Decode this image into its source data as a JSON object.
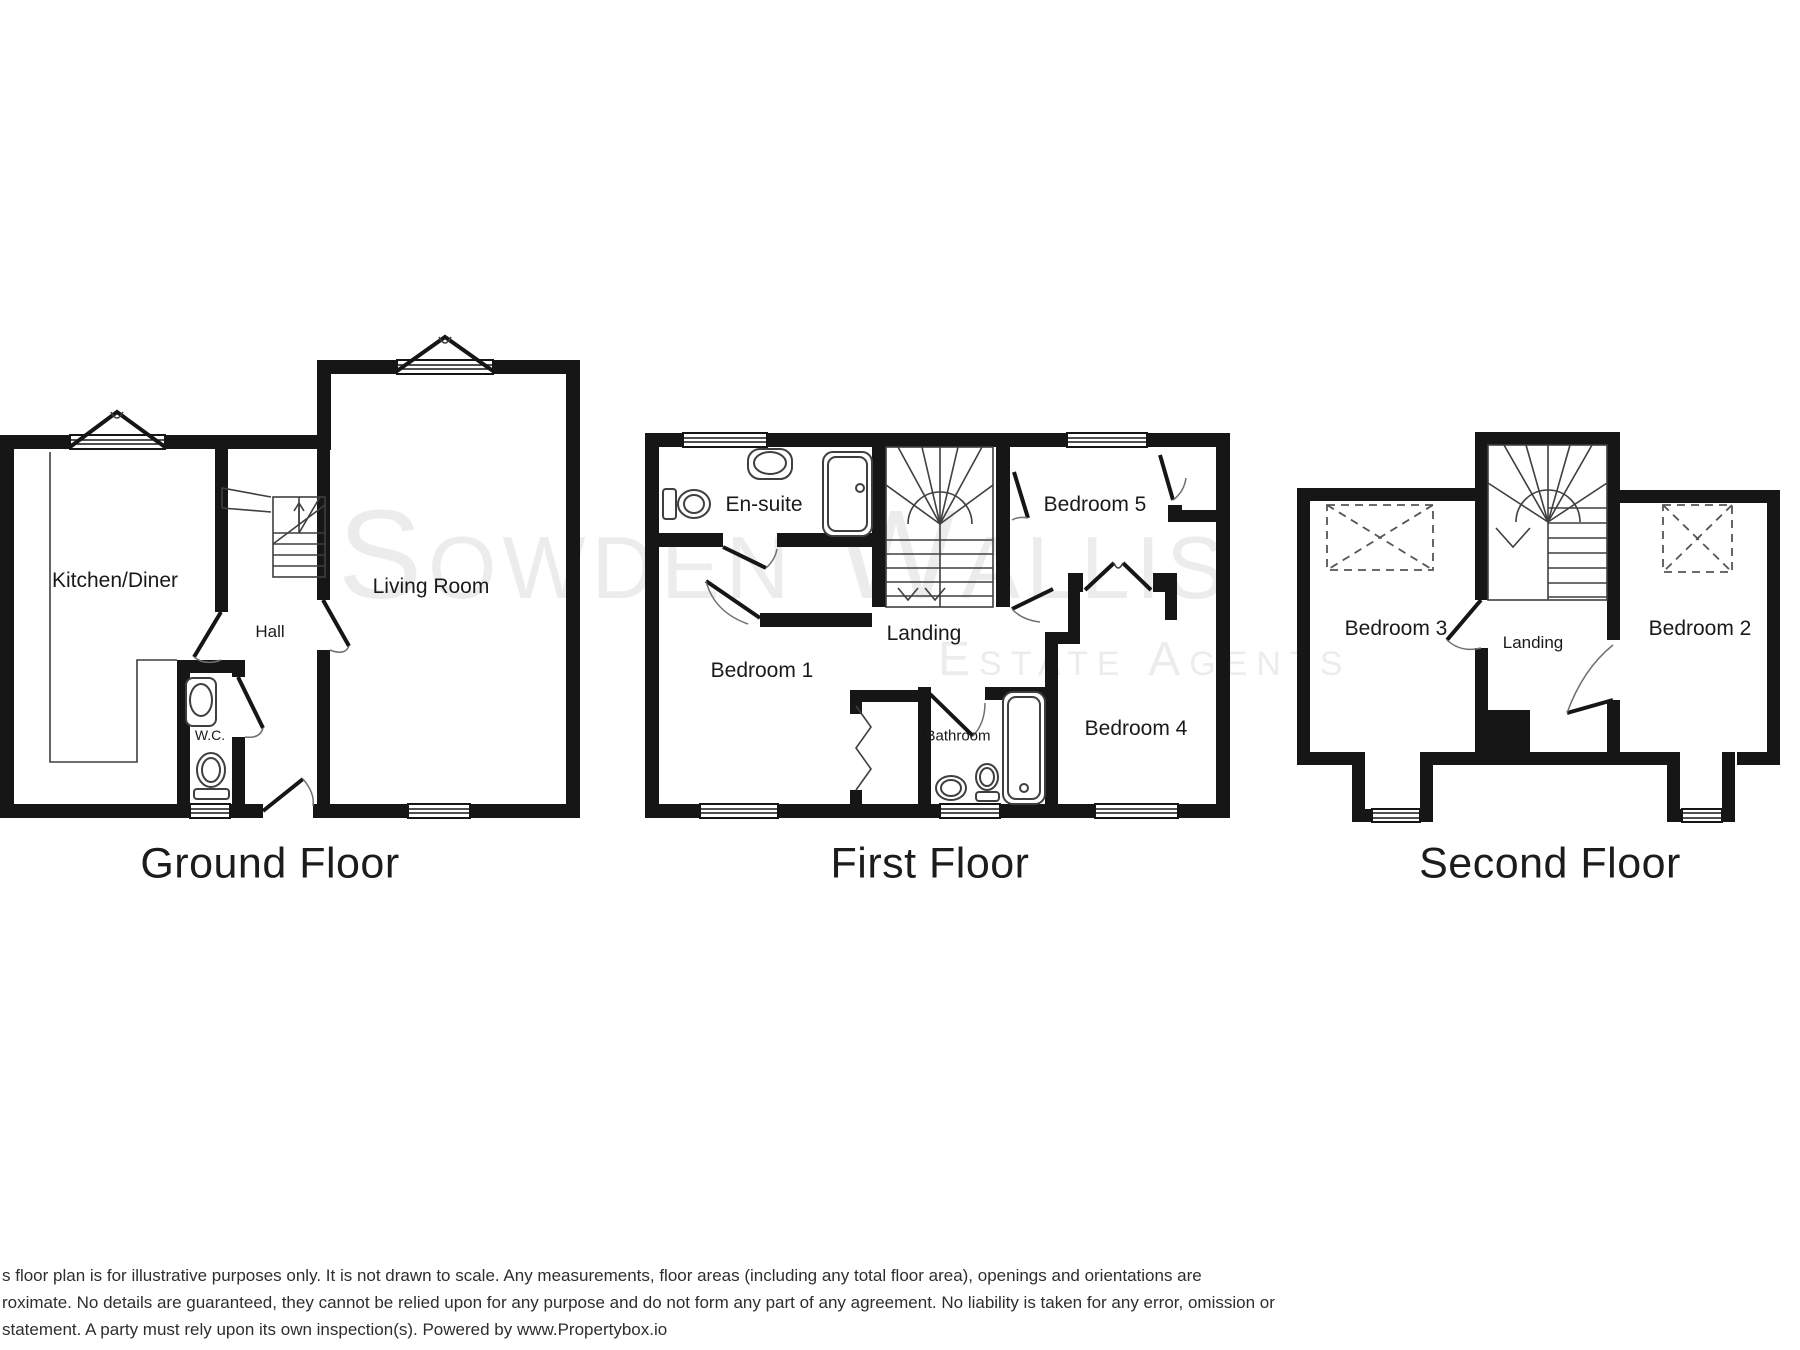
{
  "floorplan": {
    "floors": [
      {
        "title": "Ground Floor",
        "rooms": [
          {
            "name": "Kitchen/Diner"
          },
          {
            "name": "Hall"
          },
          {
            "name": "W.C."
          },
          {
            "name": "Living Room"
          }
        ]
      },
      {
        "title": "First Floor",
        "rooms": [
          {
            "name": "En-suite"
          },
          {
            "name": "Bedroom 5"
          },
          {
            "name": "Bedroom 1"
          },
          {
            "name": "Landing"
          },
          {
            "name": "Bathroom"
          },
          {
            "name": "Bedroom 4"
          }
        ]
      },
      {
        "title": "Second Floor",
        "rooms": [
          {
            "name": "Bedroom 3"
          },
          {
            "name": "Landing"
          },
          {
            "name": "Bedroom 2"
          }
        ]
      }
    ],
    "watermark": {
      "name": "Sowden Wallis",
      "tagline": "Estate Agents"
    },
    "disclaimer": {
      "line1": "s floor plan is for illustrative purposes only. It is not drawn to scale. Any measurements, floor areas (including any total floor area), openings and orientations are",
      "line2": "roximate. No details are guaranteed, they cannot be relied upon for any purpose and do not form any part of any agreement. No liability is taken for any error, omission or",
      "line3": "statement. A party must rely upon its own inspection(s). Powered by www.Propertybox.io"
    },
    "colors": {
      "wall": "#161616",
      "watermark": "#ececec",
      "fixture_line": "#3f3f3f",
      "text": "#1a1a1a",
      "disclaimer_text": "#2e2e2e",
      "background": "#ffffff"
    }
  }
}
